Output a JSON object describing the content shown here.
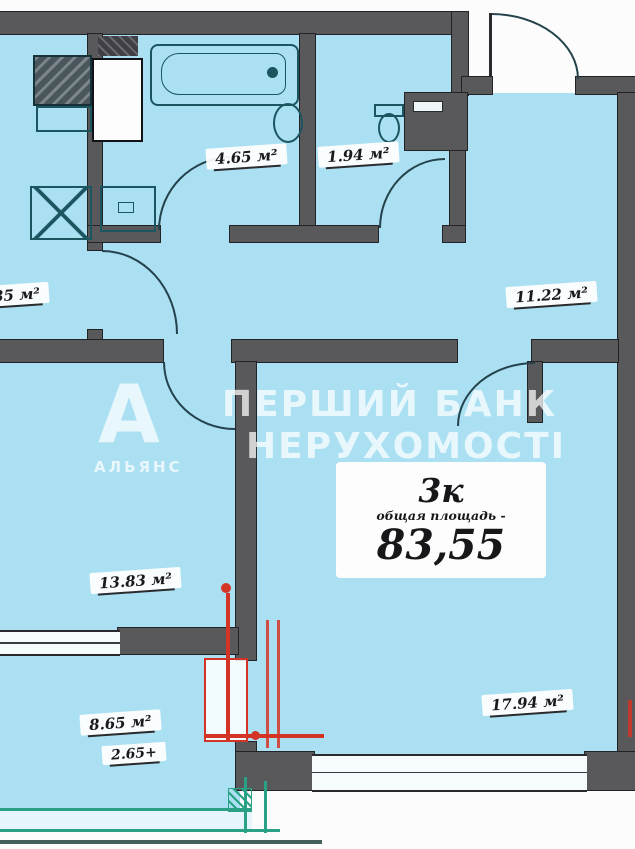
{
  "plan": {
    "summary": {
      "rooms_short": "3к",
      "total_caption": "общая площадь -",
      "total_value": "83,55"
    },
    "labels": {
      "bathroom": "4.65 м²",
      "wc": "1.94 м²",
      "left_room": "35 м²",
      "hallway": "11.22 м²",
      "bedroom": "13.83 м²",
      "kitchen": "8.65 м²",
      "kitchen_extra": "2.65+",
      "living_room": "17.94 м²"
    }
  },
  "watermark": {
    "logo_letter": "А",
    "logo_caption": "АЛЬЯНС",
    "line1": "ПЕРШИЙ БАНК",
    "line2": "НЕРУХОМОСТІ"
  },
  "colors": {
    "floor_fill": "#abe0f2",
    "wall": "#59595c",
    "annotation_red": "#d43425",
    "balcony_green": "#2aa184",
    "fixture_teal": "#1b5560",
    "watermark_white": "rgba(255,255,255,0.72)",
    "label_ink": "#1a1a1d"
  }
}
